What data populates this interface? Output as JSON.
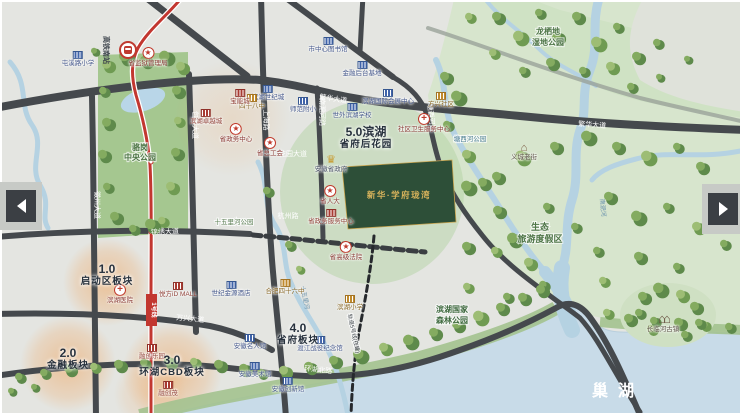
{
  "map": {
    "sections": [
      {
        "num": "1.0",
        "name": "启动区板块",
        "x": 107,
        "y": 263
      },
      {
        "num": "2.0",
        "name": "金融板块",
        "x": 68,
        "y": 347
      },
      {
        "num": "3.0",
        "name": "环湖CBD板块",
        "x": 172,
        "y": 354
      },
      {
        "num": "4.0",
        "name": "省府板块",
        "x": 298,
        "y": 322
      },
      {
        "num": "5.0滨湖",
        "name": "省府后花园",
        "x": 366,
        "y": 126
      }
    ],
    "road_labels": [
      {
        "text": "繁华大道",
        "x": 333,
        "y": 101,
        "rot": 8
      },
      {
        "text": "繁华大道",
        "x": 592,
        "y": 127,
        "rot": 4
      },
      {
        "text": "锦绣大道",
        "x": 165,
        "y": 234,
        "rot": -2
      },
      {
        "text": "万兴大道",
        "x": 190,
        "y": 321,
        "rot": 5
      },
      {
        "text": "花园大道",
        "x": 293,
        "y": 156,
        "rot": 0
      },
      {
        "text": "杭州路",
        "x": 288,
        "y": 218,
        "rot": 0
      },
      {
        "text": "环湖北路",
        "x": 318,
        "y": 372,
        "rot": 6
      },
      {
        "text": "徽州大道",
        "x": 95,
        "y": 205,
        "rot": 90
      },
      {
        "text": "包河大道",
        "x": 193,
        "y": 125,
        "rot": 90
      },
      {
        "text": "上海路",
        "x": 264,
        "y": 120,
        "rot": 90
      },
      {
        "text": "南淝河路",
        "x": 320,
        "y": 112,
        "rot": 90
      },
      {
        "text": "塘西河路",
        "x": 429,
        "y": 118,
        "rot": 84
      }
    ],
    "map_labels": [
      {
        "text": "骆岗",
        "x": 140,
        "y": 150,
        "size": 8,
        "color": "#4e7547",
        "bold": 1,
        "halo": 1
      },
      {
        "text": "中央公园",
        "x": 140,
        "y": 160,
        "size": 8,
        "color": "#4e7547",
        "bold": 1,
        "halo": 1
      },
      {
        "text": "十五里河公园",
        "x": 234,
        "y": 224,
        "size": 6.5,
        "color": "#5d8055",
        "halo": 1
      },
      {
        "text": "塘西河公园",
        "x": 470,
        "y": 141,
        "size": 6.5,
        "color": "#4a7d92",
        "halo": 1
      },
      {
        "text": "龙栖地",
        "x": 548,
        "y": 34,
        "size": 8,
        "color": "#4e7547",
        "bold": 1,
        "halo": 1
      },
      {
        "text": "湿地公园",
        "x": 548,
        "y": 45,
        "size": 8,
        "color": "#4e7547",
        "bold": 1,
        "halo": 1
      },
      {
        "text": "生态",
        "x": 540,
        "y": 230,
        "size": 9,
        "color": "#4e7547",
        "bold": 1,
        "halo": 1
      },
      {
        "text": "旅游度假区",
        "x": 540,
        "y": 242,
        "size": 9,
        "color": "#4e7547",
        "bold": 1,
        "halo": 1
      },
      {
        "text": "滨湖国家",
        "x": 452,
        "y": 312,
        "size": 8,
        "color": "#3f6a3f",
        "bold": 1,
        "halo": 1
      },
      {
        "text": "森林公园",
        "x": 452,
        "y": 323,
        "size": 8,
        "color": "#3f6a3f",
        "bold": 1,
        "halo": 1
      },
      {
        "text": "巢湖",
        "x": 618,
        "y": 396,
        "size": 16,
        "color": "#ffffff",
        "bold": 1,
        "ls": 10
      },
      {
        "text": "十五里河",
        "x": 303,
        "y": 298,
        "size": 6,
        "color": "#6b93ad",
        "rot": 78
      },
      {
        "text": "南淝河",
        "x": 601,
        "y": 208,
        "size": 6,
        "color": "#6b93ad",
        "rot": 84
      },
      {
        "text": "轨道5号线(在建)",
        "x": 352,
        "y": 334,
        "size": 5.5,
        "color": "#3c4248",
        "rot": 78,
        "halo": 1
      },
      {
        "text": "高铁南站",
        "x": 104,
        "y": 50,
        "size": 7,
        "color": "#3f464e",
        "bold": 1,
        "rot": 90
      },
      {
        "text": "1号线",
        "x": 152,
        "y": 310,
        "size": 6,
        "color": "#ffffff",
        "bold": 1,
        "rot": 90
      }
    ],
    "pois": [
      {
        "t": "star",
        "x": 148,
        "y": 52,
        "label": "省监狱管理局"
      },
      {
        "t": "blue",
        "x": 78,
        "y": 56,
        "label": "屯溪路小学"
      },
      {
        "t": "blue",
        "x": 328,
        "y": 42,
        "label": "市中心图书馆"
      },
      {
        "t": "blue",
        "x": 362,
        "y": 66,
        "label": "金融后台基地"
      },
      {
        "t": "blue",
        "x": 268,
        "y": 90,
        "label": "滨湖世纪城"
      },
      {
        "t": "gold",
        "x": 252,
        "y": 99,
        "label": "四十八中"
      },
      {
        "t": "blue",
        "x": 303,
        "y": 102,
        "label": "师范附小"
      },
      {
        "t": "blue",
        "x": 352,
        "y": 108,
        "label": "世外滨湖学校"
      },
      {
        "t": "blue",
        "x": 388,
        "y": 94,
        "label": "滨湖国际会展中心"
      },
      {
        "t": "cross",
        "x": 424,
        "y": 118,
        "label": "社区卫生服务中心"
      },
      {
        "t": "red",
        "x": 206,
        "y": 114,
        "label": "滨湖卓越城"
      },
      {
        "t": "red",
        "x": 240,
        "y": 94,
        "label": "宝能城"
      },
      {
        "t": "star",
        "x": 236,
        "y": 128,
        "label": "省政务中心"
      },
      {
        "t": "star",
        "x": 270,
        "y": 142,
        "label": "省总工会"
      },
      {
        "t": "crown",
        "x": 331,
        "y": 160,
        "label": "安徽省政府"
      },
      {
        "t": "star",
        "x": 330,
        "y": 190,
        "label": "省人大"
      },
      {
        "t": "red",
        "x": 331,
        "y": 214,
        "label": "省政务服务中心"
      },
      {
        "t": "star",
        "x": 346,
        "y": 246,
        "label": "省高级法院"
      },
      {
        "t": "gold",
        "x": 441,
        "y": 97,
        "label": "方兴社区"
      },
      {
        "t": "house",
        "x": 524,
        "y": 148,
        "label": "义城老街"
      },
      {
        "t": "gold",
        "x": 285,
        "y": 284,
        "label": "合肥四十六中"
      },
      {
        "t": "gold",
        "x": 350,
        "y": 300,
        "label": "滨湖小学"
      },
      {
        "t": "blue",
        "x": 231,
        "y": 286,
        "label": "世纪金源酒店"
      },
      {
        "t": "red",
        "x": 178,
        "y": 287,
        "label": "悦方iD MALL"
      },
      {
        "t": "cross",
        "x": 120,
        "y": 289,
        "label": "滨湖医院"
      },
      {
        "t": "red",
        "x": 152,
        "y": 349,
        "label": "融创乐园"
      },
      {
        "t": "red",
        "x": 168,
        "y": 386,
        "label": "融创茂"
      },
      {
        "t": "blue",
        "x": 250,
        "y": 339,
        "label": "安徽名人馆"
      },
      {
        "t": "blue",
        "x": 320,
        "y": 341,
        "label": "渡江战役纪念馆"
      },
      {
        "t": "blue",
        "x": 255,
        "y": 367,
        "label": "安徽美术馆"
      },
      {
        "t": "blue",
        "x": 288,
        "y": 382,
        "label": "安徽创新馆"
      },
      {
        "t": "temple",
        "x": 663,
        "y": 318,
        "label": "长临河古镇"
      }
    ],
    "project": {
      "name": "新华·学府珑湾"
    },
    "station": {
      "label": "高铁南站"
    }
  }
}
